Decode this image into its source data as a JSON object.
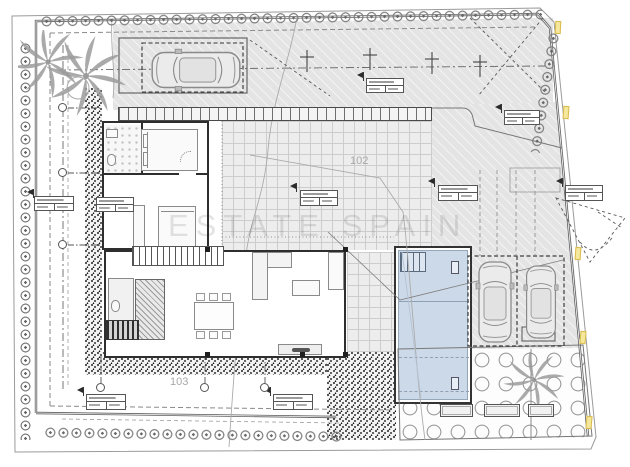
{
  "drawing": {
    "type": "architectural-site-plan",
    "watermark_text": "ESTATE SPAIN",
    "zone_labels": {
      "upper": "102",
      "lower": "103"
    },
    "colors": {
      "pool_water": "#ccd9e8",
      "paving_gray": "#e4e4e4",
      "grid_paving": "#ededed",
      "marker_yellow": "#f5e79b",
      "wall_black": "#2e2e2e",
      "watermark_gray": "rgba(50,50,50,0.13)"
    },
    "counts": {
      "garage_cars": 1,
      "parked_cars": 2,
      "parking_bays": 2,
      "pools": 1,
      "boundary_highlight_markers": 5,
      "spot_level_tables": 9,
      "axis_bubbles": 6,
      "palm_groups": 2,
      "garden_planters": 3,
      "light_pole_markers": 4
    },
    "elements": [
      "boundary-hedge",
      "palm-trees",
      "garage",
      "driveway",
      "covered-terrace",
      "bedroom-wing",
      "living-wing",
      "kitchen-island",
      "dining-table",
      "sofa",
      "stairs",
      "swimming-pool",
      "parking-bays",
      "gravel-strips",
      "garden",
      "planters",
      "spot-level-tables",
      "axis-bubbles",
      "watermark"
    ]
  }
}
